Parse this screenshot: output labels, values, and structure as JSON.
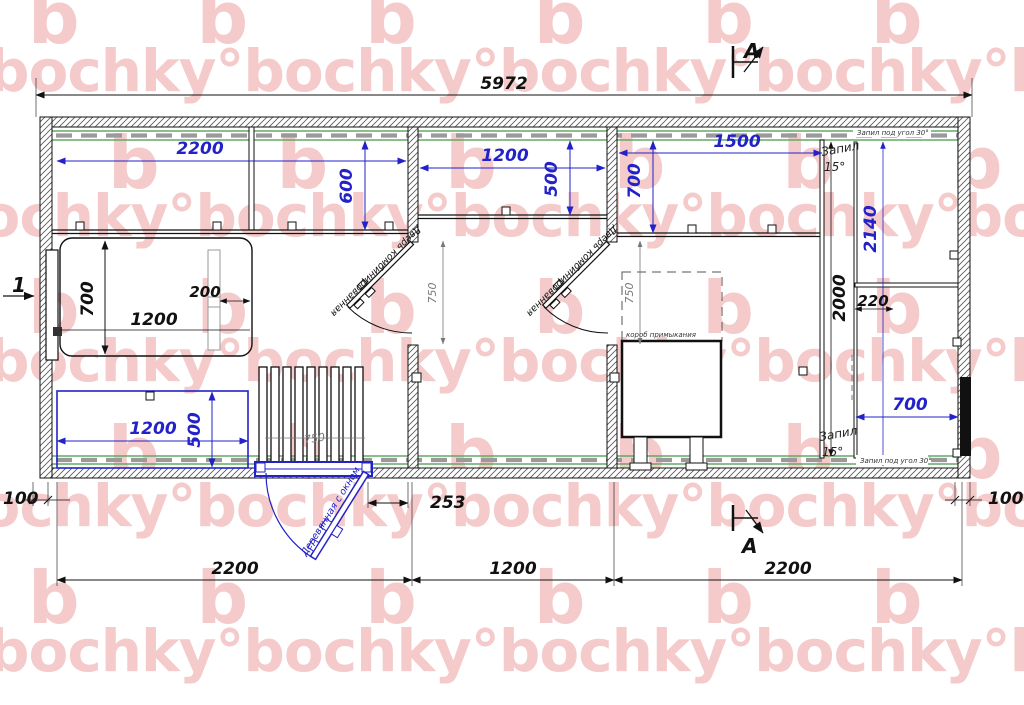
{
  "watermark": {
    "letter_row": "b b b b b b",
    "word_row": "bochky°bochky°bochky°bochky°bochky°bochky°"
  },
  "dims": {
    "overall": "5972",
    "room1_top": "2200",
    "room1_shelf": "600",
    "room2_top": "1200",
    "room2_shelf": "500",
    "room3_shelf_w": "1500",
    "room3_shelf_d": "700",
    "bed_w": "700",
    "bed_l": "1200",
    "headrest": "200",
    "bench_l": "1200",
    "bench_d": "500",
    "porch": "750",
    "door1": "750",
    "door2": "750",
    "screen": "2000",
    "bench_r": "2140",
    "step": "220",
    "bench_low": "700",
    "off_l": "100",
    "off_r": "100",
    "porch_off": "253",
    "bot1": "2200",
    "bot2": "1200",
    "bot3": "2200"
  },
  "labels": {
    "door_a": "Дверь комбинированная",
    "door_b": "Дверь комбинированная",
    "entrance": "Деревянная с окном",
    "cut30_top": "Запил под угол 30°",
    "cut30_bot": "Запил под угол 30°",
    "bevel_word_top": "Запил",
    "bevel_deg_top": "15°",
    "bevel_word_bot": "Запил",
    "bevel_deg_bot": "15°",
    "stove": "короб примыкания"
  },
  "markers": {
    "section": "A",
    "position": "1"
  },
  "colors": {
    "dimension_blue": "#2222c8",
    "watermark_pink": "#f5caca",
    "insulation_green": "#63a863"
  }
}
